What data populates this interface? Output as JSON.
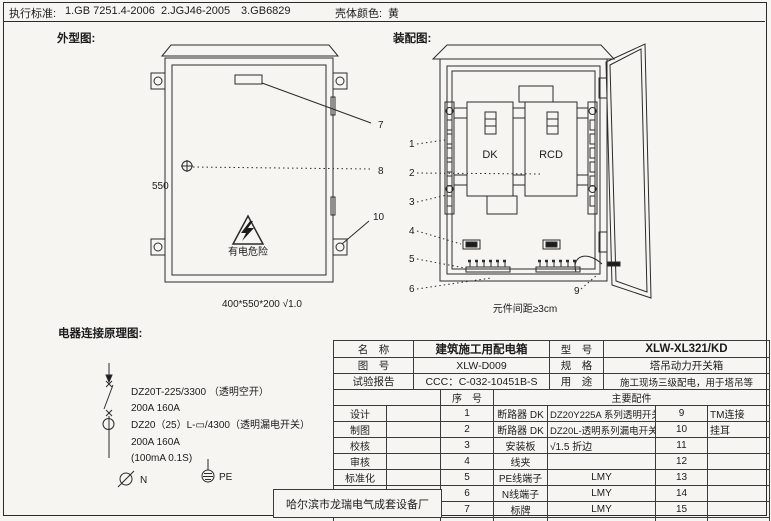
{
  "header": {
    "standards_label": "执行标准:",
    "standards": [
      "1.GB 7251.4-2006",
      "2.JGJ46-2005",
      "3.GB6829"
    ],
    "shell_color_label": "壳体颜色:",
    "shell_color": "黄"
  },
  "outline": {
    "title": "外型图:",
    "height_dim": "550",
    "warning_text": "有电危险",
    "size_note": "400*550*200  √1.0",
    "callouts": [
      "7",
      "8",
      "10"
    ]
  },
  "assembly": {
    "title": "装配图:",
    "dk_label": "DK",
    "rcd_label": "RCD",
    "spacing_note": "元件间距≥3cm",
    "callouts": [
      "1",
      "2",
      "3",
      "4",
      "5",
      "6"
    ],
    "callout9": "9"
  },
  "schematic": {
    "title": "电器连接原理图:",
    "lines": [
      "DZ20T-225/3300 （透明空开）",
      "200A  160A",
      "DZ20（25）L-▭/4300（透明漏电开关）",
      "200A  160A",
      "(100mA 0.1S)"
    ],
    "n_label": "N",
    "pe_label": "PE"
  },
  "title_block": {
    "info": {
      "name_label": "名　称",
      "name": "建筑施工用配电箱",
      "model_label": "型　号",
      "model": "XLW-XL321/KD",
      "drawing_no_label": "图　号",
      "drawing_no": "XLW-D009",
      "spec_label": "规　格",
      "spec": "塔吊动力开关箱",
      "test_label": "试验报告",
      "test": "CCC：C-032-10451B-S",
      "use_label": "用　途",
      "use": "施工现场三级配电，用于塔吊等"
    },
    "seq_header": "序　号",
    "parts_header": "主要配件",
    "sign_rows": [
      "设计",
      "制图",
      "校核",
      "审核",
      "标准化",
      "日期"
    ],
    "rows": [
      {
        "seq": "1",
        "name": "断路器 DK",
        "desc": "DZ20Y225A 系列透明开关",
        "seq2": "9",
        "desc2": "TM连接"
      },
      {
        "seq": "2",
        "name": "断路器 DK",
        "desc": "DZ20L-透明系列漏电开关",
        "seq2": "10",
        "desc2": "挂耳"
      },
      {
        "seq": "3",
        "name": "安装板",
        "desc": "√1.5 折边",
        "seq2": "11",
        "desc2": ""
      },
      {
        "seq": "4",
        "name": "线夹",
        "desc": "",
        "seq2": "12",
        "desc2": ""
      },
      {
        "seq": "5",
        "name": "PE线端子",
        "desc": "LMY",
        "seq2": "13",
        "desc2": ""
      },
      {
        "seq": "6",
        "name": "N线端子",
        "desc": "LMY",
        "seq2": "14",
        "desc2": ""
      },
      {
        "seq": "7",
        "name": "标牌",
        "desc": "LMY",
        "seq2": "15",
        "desc2": ""
      },
      {
        "seq": "8",
        "name": "压把锁孔",
        "desc": "防雨",
        "seq2": "16",
        "desc2": ""
      }
    ],
    "factory": "哈尔滨市龙瑞电气成套设备厂"
  }
}
